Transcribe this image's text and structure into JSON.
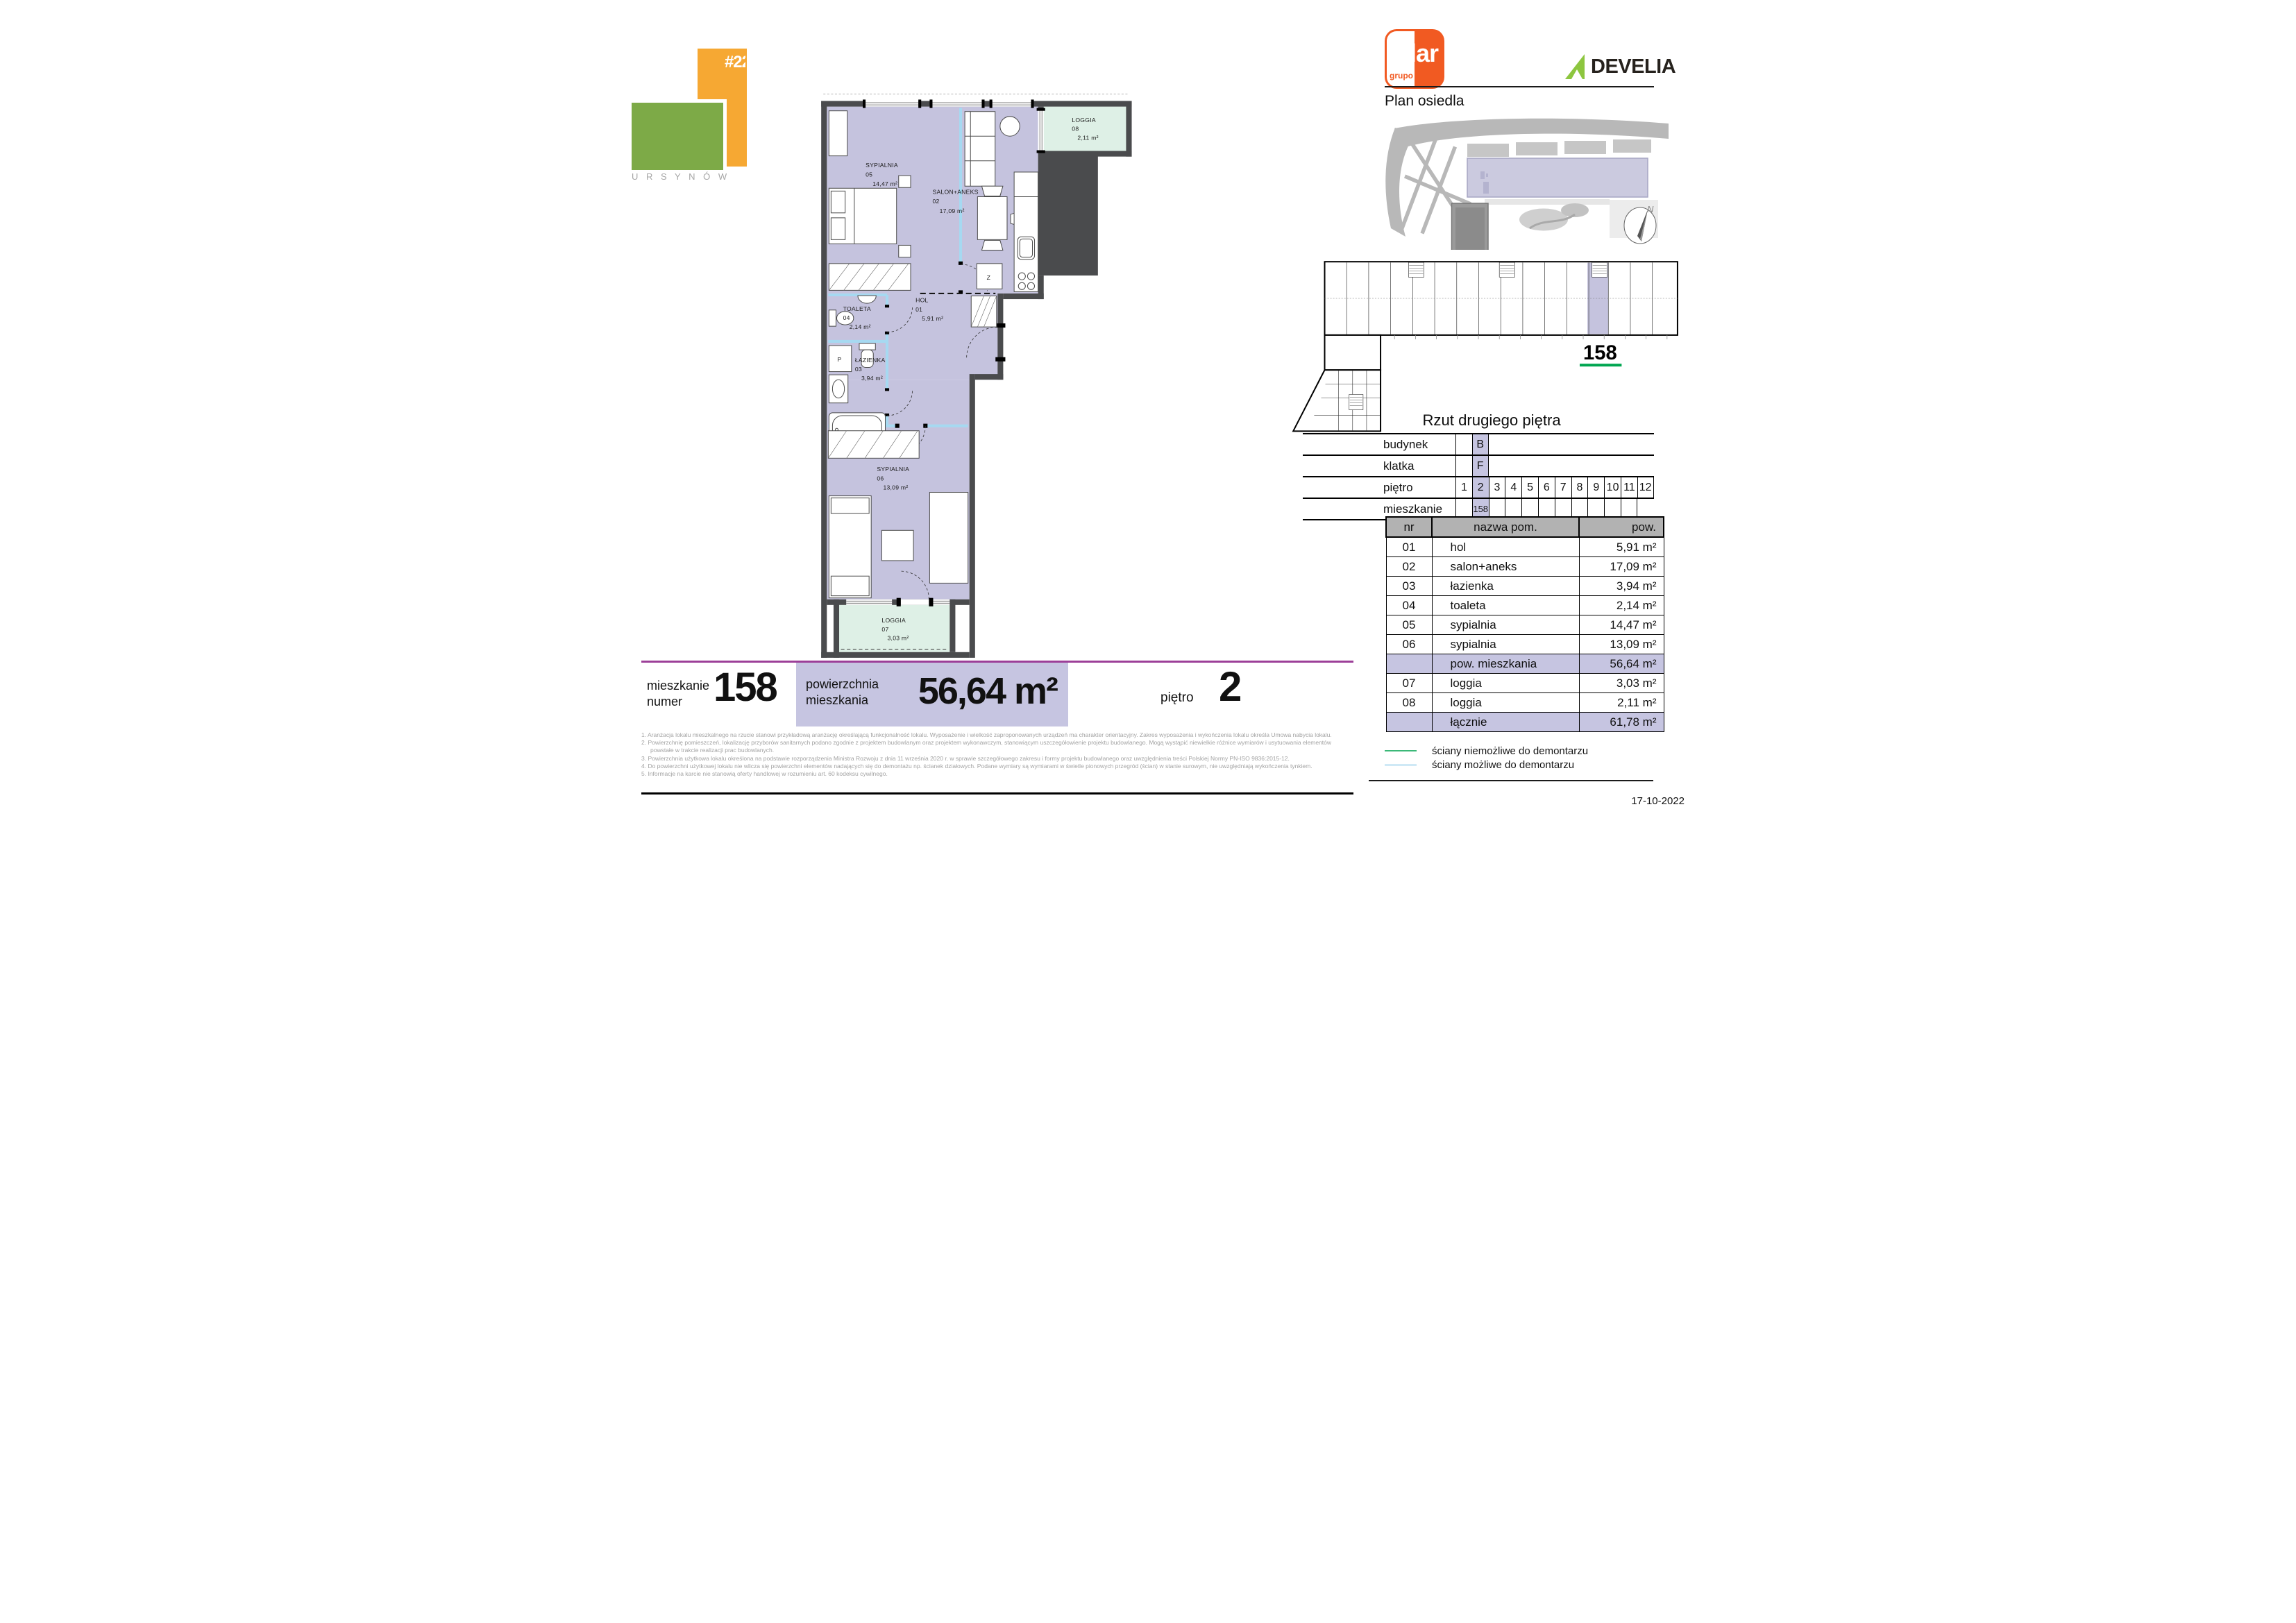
{
  "logo": {
    "tag": "#22",
    "city": "U R S Y N Ó W"
  },
  "brand": {
    "grupo": "grupo",
    "lar": "lar",
    "develia": "DEVELIA"
  },
  "map": {
    "title": "Plan osiedla",
    "north": "N"
  },
  "building": {
    "unit": "158",
    "caption": "Rzut drugiego piętra"
  },
  "info": {
    "labels": [
      "budynek",
      "klatka",
      "piętro",
      "mieszkanie"
    ],
    "budynek": "B",
    "klatka": "F",
    "pietro": [
      "1",
      "2",
      "3",
      "4",
      "5",
      "6",
      "7",
      "8",
      "9",
      "10",
      "11",
      "12"
    ],
    "mieszkanie": "158"
  },
  "room_table": {
    "headers": [
      "nr",
      "nazwa pom.",
      "pow."
    ],
    "rows": [
      {
        "nr": "01",
        "name": "hol",
        "pow": "5,91 m²"
      },
      {
        "nr": "02",
        "name": "salon+aneks",
        "pow": "17,09 m²"
      },
      {
        "nr": "03",
        "name": "łazienka",
        "pow": "3,94 m²"
      },
      {
        "nr": "04",
        "name": "toaleta",
        "pow": "2,14 m²"
      },
      {
        "nr": "05",
        "name": "sypialnia",
        "pow": "14,47 m²"
      },
      {
        "nr": "06",
        "name": "sypialnia",
        "pow": "13,09 m²"
      },
      {
        "nr": "",
        "name": "pow. mieszkania",
        "pow": "56,64 m²"
      },
      {
        "nr": "07",
        "name": "loggia",
        "pow": "3,03 m²"
      },
      {
        "nr": "08",
        "name": "loggia",
        "pow": "2,11 m²"
      },
      {
        "nr": "",
        "name": "łącznie",
        "pow": "61,78 m²"
      }
    ]
  },
  "legend": {
    "items": [
      {
        "label": "ściany niemożliwe do demontarzu"
      },
      {
        "label": "ściany możliwe do demontarzu"
      }
    ]
  },
  "date": "17-10-2022",
  "bottom": {
    "apt_l1": "mieszkanie",
    "apt_l2": "numer",
    "apt_no": "158",
    "area_l1": "powierzchnia",
    "area_l2": "mieszkania",
    "area": "56,64 m²",
    "floor_l": "piętro",
    "floor": "2",
    "footnotes": [
      "1. Aranżacja lokalu mieszkalnego na rzucie stanowi przykładową aranżację określającą funkcjonalność lokalu. Wyposażenie i wielkość zaproponowanych urządzeń ma charakter orientacyjny. Zakres wyposażenia i wykończenia lokalu określa Umowa nabycia lokalu.",
      "2. Powierzchnię pomieszczeń, lokalizację przyborów sanitarnych podano zgodnie z projektem budowlanym oraz projektem wykonawczym, stanowiącym uszczegółowienie projektu budowlanego. Mogą wystąpić niewielkie różnice wymiarów i usytuowania elementów powstałe w trakcie realizacji prac budowlanych.",
      "3. Powierzchnia użytkowa lokalu określona na podstawie rozporządzenia Ministra Rozwoju z dnia 11 września 2020 r. w sprawie szczegółowego zakresu i formy projektu budowlanego oraz uwzględnienia treści Polskiej Normy PN-ISO 9836:2015-12.",
      "4. Do powierzchni użytkowej lokalu nie wlicza się powierzchni elementów nadających się do demontażu np. ścianek działowych. Podane wymiary są wymiarami w świetle pionowych przegród (ścian) w stanie surowym, nie uwzględniają wykończenia tynkiem.",
      "5. Informacje na karcie nie stanowią oferty handlowej w rozumieniu art. 60 kodeksu cywilnego."
    ]
  },
  "plan": {
    "r01": {
      "n": "HOL",
      "no": "01",
      "a": "5,91 m²"
    },
    "r02": {
      "n": "SALON+ANEKS",
      "no": "02",
      "a": "17,09 m²"
    },
    "r03": {
      "n": "ŁAZIENKA",
      "no": "03",
      "a": "3,94 m²"
    },
    "r04": {
      "n": "TOALETA",
      "no": "04",
      "a": "2,14 m²"
    },
    "r05": {
      "n": "SYPIALNIA",
      "no": "05",
      "a": "14,47 m²"
    },
    "r06": {
      "n": "SYPIALNIA",
      "no": "06",
      "a": "13,09 m²"
    },
    "r07": {
      "n": "LOGGIA",
      "no": "07",
      "a": "3,03 m²"
    },
    "r08": {
      "n": "LOGGIA",
      "no": "08",
      "a": "2,11 m²"
    },
    "z": "Z",
    "p": "P"
  },
  "colors": {
    "accent_orange": "#f15a22",
    "develia_green": "#8dc63f",
    "logo_orange": "#f6a833",
    "logo_green": "#7daa47",
    "room_lavender": "#c5c3de",
    "loggia_mint": "#def0e6",
    "wall_gray": "#4a4b4d",
    "partition_blue": "#a6d9f1",
    "highlight_lavender": "#c6c5e1",
    "header_gray": "#b2b2b2",
    "magenta_rule": "#9c3f98",
    "green_underline": "#00a651",
    "legend_green": "#3cb878",
    "legend_blue": "#cfe9f6"
  }
}
